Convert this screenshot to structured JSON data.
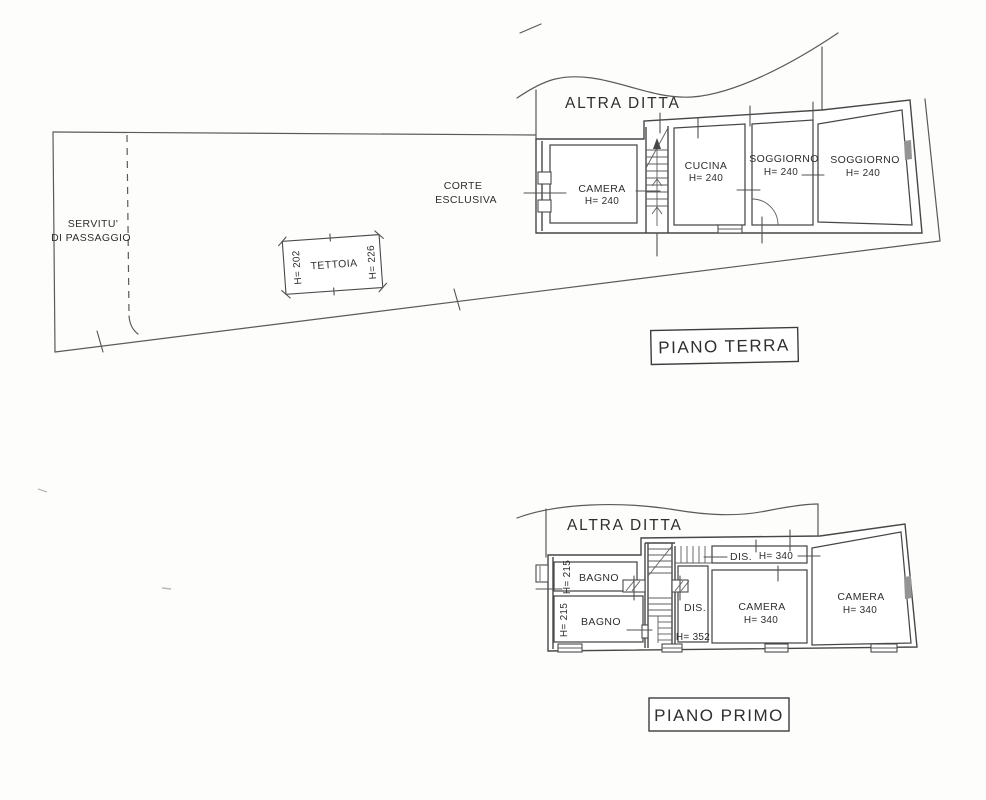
{
  "ground_floor": {
    "altra_ditta": "ALTRA DITTA",
    "servitu_line1": "SERVITU'",
    "servitu_line2": "DI PASSAGGIO",
    "corte_line1": "CORTE",
    "corte_line2": "ESCLUSIVA",
    "tettoia": {
      "label": "TETTOIA",
      "h_left": "H= 202",
      "h_right": "H= 226"
    },
    "rooms": [
      {
        "name": "CAMERA",
        "h": "H= 240"
      },
      {
        "name": "CUCINA",
        "h": "H= 240"
      },
      {
        "name": "SOGGIORNO",
        "h": "H= 240"
      },
      {
        "name": "SOGGIORNO",
        "h": "H= 240"
      }
    ],
    "floor_label": "PIANO TERRA"
  },
  "first_floor": {
    "altra_ditta": "ALTRA DITTA",
    "rooms": [
      {
        "name": "BAGNO",
        "h": "H= 215"
      },
      {
        "name": "BAGNO",
        "h": "H= 215"
      },
      {
        "name": "DIS.",
        "h": "H= 352"
      },
      {
        "name": "DIS.",
        "h": "H= 340"
      },
      {
        "name": "CAMERA",
        "h": "H= 340"
      },
      {
        "name": "CAMERA",
        "h": "H= 340"
      }
    ],
    "floor_label": "PIANO PRIMO"
  },
  "colors": {
    "line": "#5a5a5a",
    "wall": "#474747",
    "text": "#2e2e2e",
    "window_fill": "#949494"
  }
}
